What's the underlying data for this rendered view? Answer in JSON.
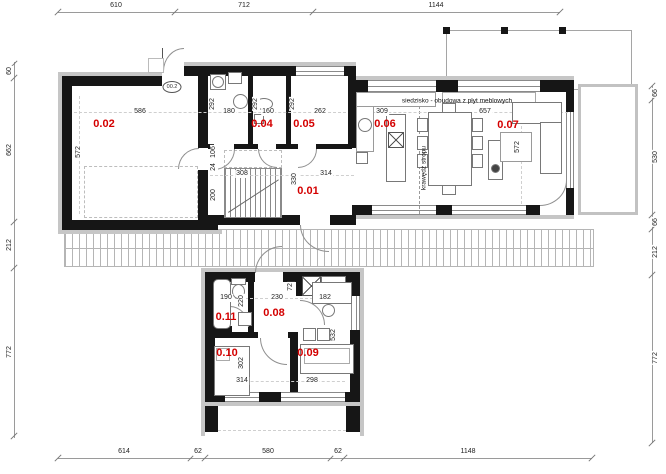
{
  "dims": {
    "top": [
      "610",
      "712",
      "1144"
    ],
    "bottom": [
      "614",
      "62",
      "580",
      "62",
      "1148"
    ],
    "left": [
      "60",
      "662",
      "212",
      "772"
    ],
    "right": [
      "66",
      "530",
      "66",
      "212",
      "772"
    ]
  },
  "rooms": {
    "r01": "0.01",
    "r02": "0.02",
    "r04": "0.04",
    "r05": "0.05",
    "r06": "0.06",
    "r07": "0.07",
    "r08": "0.08",
    "r09": "0.09",
    "r10": "0.10",
    "r11": "0.11"
  },
  "interior_dims": {
    "garage_w": "586",
    "garage_d": "572",
    "utility_w": "180",
    "utility_d": "292",
    "wc_w": "160",
    "wc_d": "292",
    "wardrobe_w": "262",
    "wardrobe_d": "292",
    "hall_a": "106",
    "hall_b": "24",
    "hall_c": "200",
    "stairs_w": "308",
    "hall_d": "330",
    "hall_w": "314",
    "kitchen_w": "309",
    "living_w": "657",
    "living_d": "572",
    "bath_w": "190",
    "bath_d": "220",
    "corridor_w": "230",
    "closet_d": "72",
    "office_w_top": "182",
    "office_d": "532",
    "office_w": "298",
    "bedroom_d": "302",
    "bedroom_w": "314"
  },
  "annotations": {
    "seating": "siedzisko - obudowa z płyt meblowych",
    "ceiling_edge": "krawędź stropu",
    "entry_door_tag": "00.2"
  },
  "colors": {
    "room_label": "#d40000",
    "wall": "#161616",
    "dim_text": "#222222"
  }
}
